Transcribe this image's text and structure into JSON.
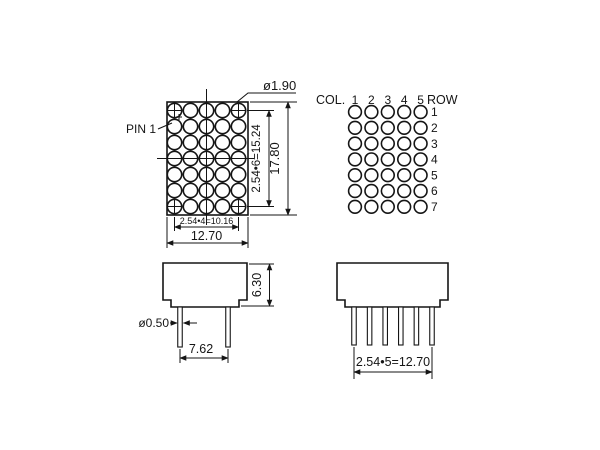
{
  "front_view": {
    "pin1_label": "PIN 1",
    "dot_diameter": "ø1.90",
    "dim_row_pitch": "2.54•6=15.24",
    "dim_height": "17.80",
    "dim_col_pitch": "2.54•4=10.16",
    "dim_width": "12.70",
    "dots": {
      "cols": 5,
      "rows": 7
    }
  },
  "pin_map": {
    "col_label": "COL.",
    "col_numbers": [
      "1",
      "2",
      "3",
      "4",
      "5"
    ],
    "row_label": "ROW",
    "row_numbers": [
      "1",
      "2",
      "3",
      "4",
      "5",
      "6",
      "7"
    ],
    "dots": {
      "cols": 5,
      "rows": 7
    }
  },
  "side_view": {
    "dim_height": "6.30",
    "pin_diameter": "ø0.50",
    "dim_pin_pitch": "7.62",
    "pin_count": 2
  },
  "front_pin_view": {
    "dim_pin_row": "2.54•5=12.70",
    "pin_count": 6
  },
  "colors": {
    "line": "#151515",
    "background": "#ffffff"
  }
}
